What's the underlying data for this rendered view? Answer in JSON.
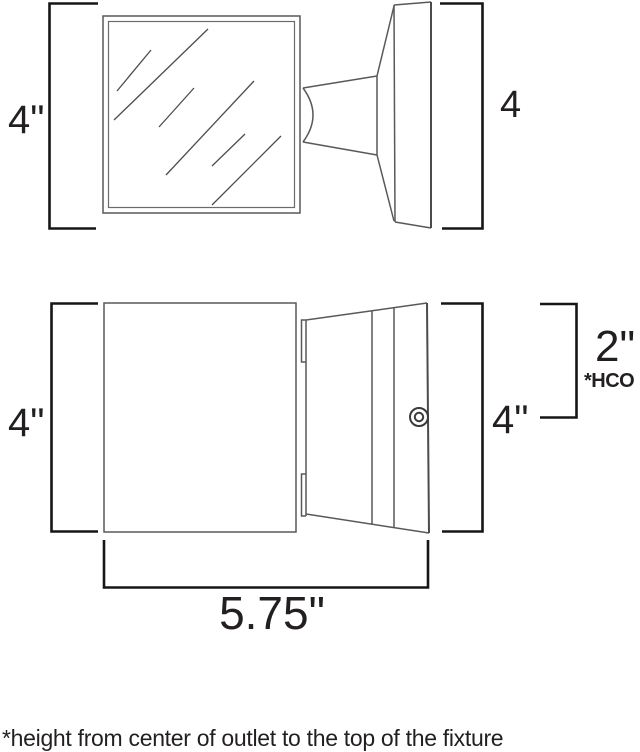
{
  "diagram": {
    "type": "fixture-dimension-drawing",
    "top_view": {
      "left_dim": "4\"",
      "right_dim": "4"
    },
    "front_view": {
      "left_dim": "4\"",
      "right_dim": "4\"",
      "hco_dim": "2\"",
      "hco_label": "*HCO",
      "width_dim": "5.75\""
    },
    "footnote": "*height from center of outlet to the top of the fixture",
    "icons": {
      "screw_head": "concentric-circles"
    },
    "colors": {
      "drawing_line": "#58595b",
      "dimension_line": "#161616",
      "text": "#231f20",
      "background": "#ffffff"
    }
  }
}
